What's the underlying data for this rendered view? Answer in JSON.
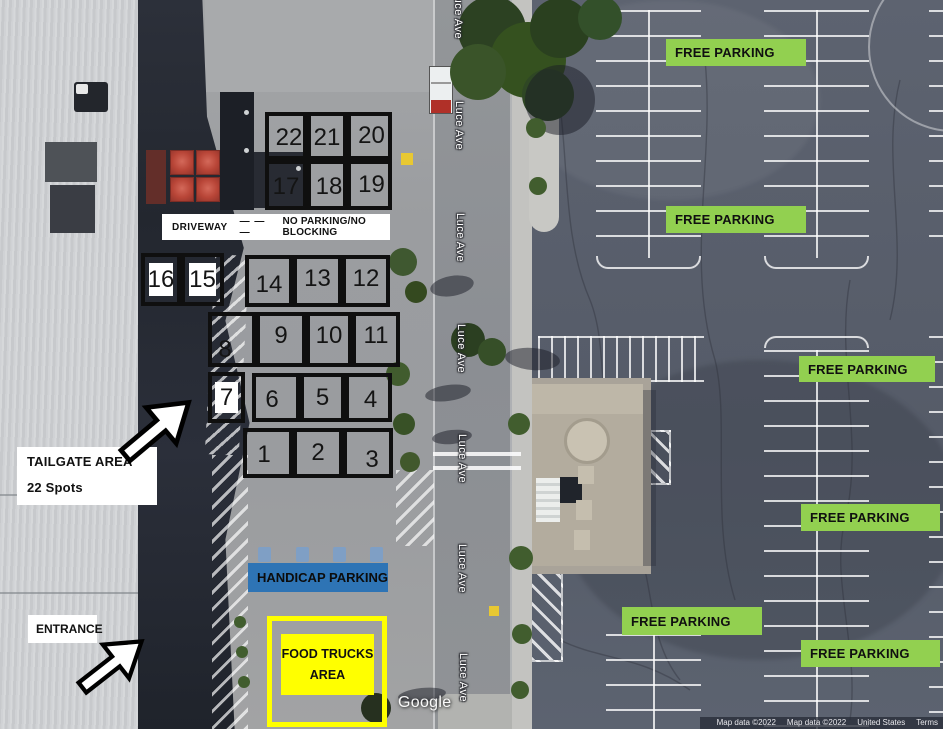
{
  "street": {
    "name": "Luce Ave"
  },
  "annotations": {
    "driveway": {
      "label": "DRIVEWAY",
      "dashes": "— — —",
      "note": "NO PARKING/NO BLOCKING"
    },
    "tailgate": {
      "title": "TAILGATE AREA",
      "subtitle": "22 Spots"
    },
    "entrance": {
      "label": "ENTRANCE"
    },
    "handicap": {
      "label": "HANDICAP PARKING",
      "color": "#2e74b5"
    },
    "food_trucks": {
      "line1": "FOOD TRUCKS",
      "line2": "AREA",
      "color": "#ffff00"
    },
    "free_parking": {
      "label": "FREE PARKING",
      "color": "#92d050"
    },
    "spots": {
      "total": 22,
      "numbers": [
        "22",
        "21",
        "20",
        "17",
        "18",
        "19",
        "16",
        "15",
        "14",
        "13",
        "12",
        "8",
        "9",
        "10",
        "11",
        "7",
        "6",
        "5",
        "4",
        "1",
        "2",
        "3"
      ]
    }
  },
  "watermark": {
    "google": "Google"
  },
  "attribution": {
    "items": [
      "Map data ©2022",
      "Map data ©2022",
      "United States",
      "Terms"
    ]
  }
}
